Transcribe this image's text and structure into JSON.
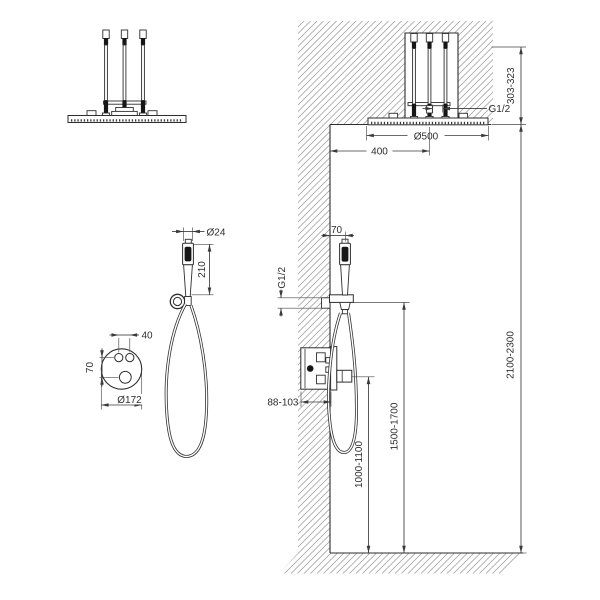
{
  "labels": {
    "section": {
      "recess_height": "303-323",
      "head_connection": "G1/2",
      "head_diameter": "Ø500",
      "head_wall_distance": "400",
      "hand_shower_wall_distance": "70",
      "outlet_connection": "G1/2",
      "valve_recess_depth": "88-103",
      "valve_height": "1000-1100",
      "outlet_height": "1500-1700",
      "ceiling_height": "2100-2300"
    },
    "hand_shower": {
      "head_diameter": "Ø24",
      "length": "210"
    },
    "valve_plate": {
      "handle_spacing": "40",
      "handle_vertical_spacing": "70",
      "plate_diameter": "Ø172"
    }
  },
  "colors": {
    "line": "#2e2e2e",
    "hatch": "#9b9b9b",
    "background": "#ffffff"
  }
}
